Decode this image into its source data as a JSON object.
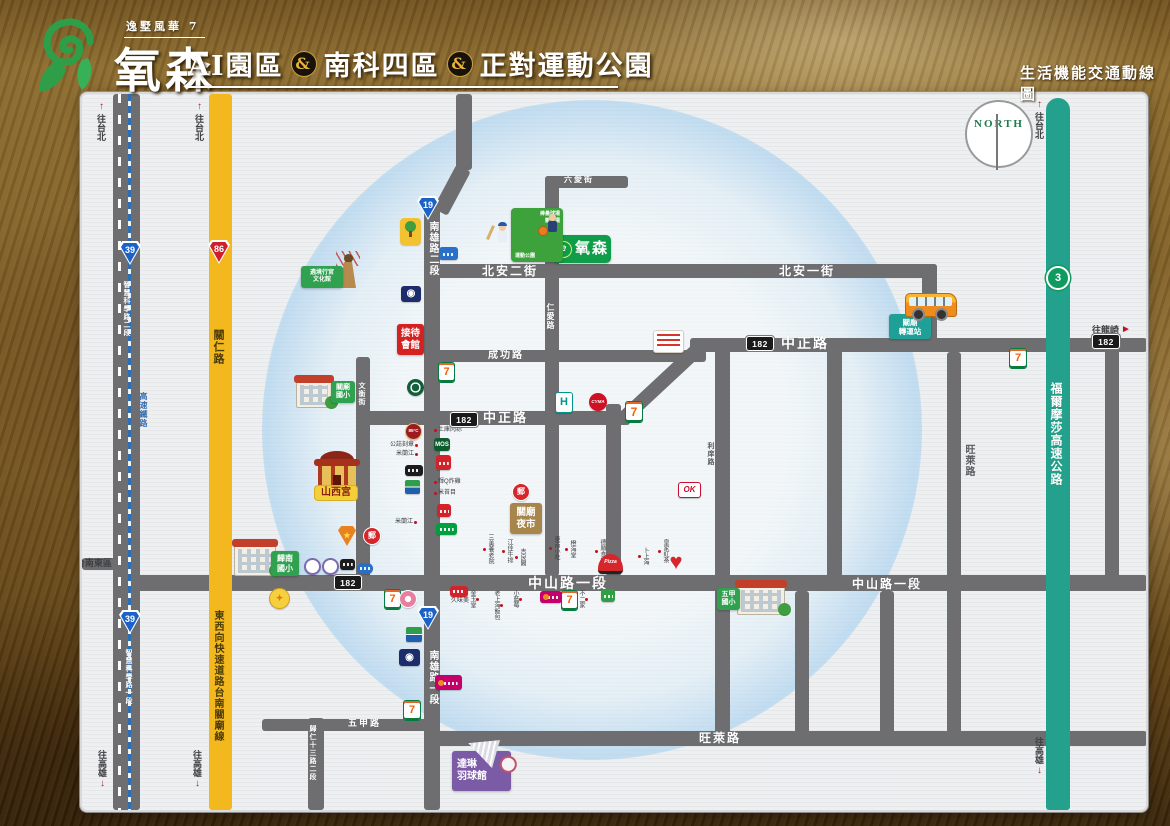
{
  "header": {
    "brand_top": "逸墅風華 7",
    "brand_name": "氧森",
    "title_segments": [
      "AI園區",
      "&",
      "南科四區",
      "&",
      "正對運動公園"
    ],
    "map_type": "生活機能交通動線圖"
  },
  "compass": {
    "label": "NORTH"
  },
  "site": {
    "logo_glyph": "e"
  },
  "roadLabels": [
    {
      "id": "beian-2nd-street",
      "text": "北安二街"
    },
    {
      "id": "beian-1st-street",
      "text": "北安一街"
    },
    {
      "id": "zhongzheng-road-north",
      "text": "中正路"
    },
    {
      "id": "zhongzheng-road-south",
      "text": "中正路"
    },
    {
      "id": "chenggong-road",
      "text": "成功路"
    },
    {
      "id": "zhongshan-road-sec1-west",
      "text": "中山路一段"
    },
    {
      "id": "zhongshan-road-sec1-east",
      "text": "中山路一段"
    },
    {
      "id": "wanglai-road-h",
      "text": "旺萊路"
    },
    {
      "id": "wanglai-road-v",
      "text": "旺萊路"
    },
    {
      "id": "wujia-road",
      "text": "五甲路"
    },
    {
      "id": "liuai-street",
      "text": "六愛街"
    },
    {
      "id": "renai-road",
      "text": "仁愛路"
    },
    {
      "id": "wenheng-street",
      "text": "文衡街"
    },
    {
      "id": "lixiang-road",
      "text": "利庠路"
    },
    {
      "id": "nanxiong-road-sec2",
      "text": "南雄路二段"
    },
    {
      "id": "nanxiong-road-sec1",
      "text": "南雄路一段"
    },
    {
      "id": "guiren-13th-road",
      "text": "歸仁十三路二段"
    },
    {
      "id": "guanren-road",
      "text": "關仁路"
    },
    {
      "id": "expressway-name",
      "text": "東西向快速道路台南關廟線"
    },
    {
      "id": "formosa-freeway",
      "text": "福爾摩莎高速公路"
    },
    {
      "id": "hsr-line",
      "text": "高速鐵路"
    },
    {
      "id": "smart-science-road-sec2",
      "text": "智慧科學路二段"
    },
    {
      "id": "smart-science-road-sec1",
      "text": "智慧科學路一段"
    }
  ],
  "dirLabels": [
    {
      "id": "to-taipei-1",
      "text": "往台北",
      "dir": "up"
    },
    {
      "id": "to-taipei-2",
      "text": "往台北",
      "dir": "up"
    },
    {
      "id": "to-taipei-3",
      "text": "往台北",
      "dir": "up"
    },
    {
      "id": "to-kaohsiung-1",
      "text": "往高雄",
      "dir": "down"
    },
    {
      "id": "to-kaohsiung-2",
      "text": "往高雄",
      "dir": "down"
    },
    {
      "id": "to-kaohsiung-3",
      "text": "往高雄",
      "dir": "down"
    },
    {
      "id": "to-tainan-east",
      "text": "往台南東區",
      "dir": "left"
    },
    {
      "id": "to-longqi",
      "text": "往龍崎",
      "dir": "right"
    }
  ],
  "shields": [
    {
      "id": "provincial-19-north",
      "number": "19"
    },
    {
      "id": "provincial-19-south",
      "number": "19"
    },
    {
      "id": "provincial-39-north",
      "number": "39"
    },
    {
      "id": "provincial-39-south",
      "number": "39"
    },
    {
      "id": "expressway-86",
      "number": "86"
    },
    {
      "id": "freeway-3",
      "number": "3"
    },
    {
      "id": "route-182-west",
      "number": "182"
    },
    {
      "id": "route-182-central",
      "number": "182"
    },
    {
      "id": "route-182-north",
      "number": "182"
    },
    {
      "id": "route-182-east",
      "number": "182"
    }
  ],
  "landmarks": [
    {
      "id": "site-sign",
      "lines": [
        "氧森"
      ]
    },
    {
      "id": "sports-park",
      "lines": [
        "棒壘球場",
        "籃球場",
        "運動公園"
      ]
    },
    {
      "id": "reception-hall",
      "lines": [
        "接待",
        "會館"
      ]
    },
    {
      "id": "shanxi-temple-label",
      "lines": [
        "山西宮"
      ]
    },
    {
      "id": "temple-culture-label",
      "lines": [
        "遶境行宮",
        "文化館"
      ]
    },
    {
      "id": "guanmiao-night-market",
      "lines": [
        "關廟",
        "夜市"
      ]
    },
    {
      "id": "dalin-badminton-hall",
      "lines": [
        "達琳",
        "羽球館"
      ]
    },
    {
      "id": "guanmiao-bus-station",
      "lines": [
        "關廟",
        "轉運站"
      ]
    },
    {
      "id": "guannan-elementary",
      "lines": [
        "歸南",
        "國小"
      ]
    },
    {
      "id": "guanmiao-elementary",
      "lines": [
        "關廟",
        "國小"
      ]
    },
    {
      "id": "wujia-elementary",
      "lines": [
        "五甲",
        "國小"
      ]
    }
  ],
  "microLabels": [
    {
      "id": "poi-tuku-rice-dumpling",
      "text": "土庫肉粽",
      "dot": "left"
    },
    {
      "id": "poi-seal-shop",
      "text": "公誌刻章",
      "dot": "right"
    },
    {
      "id": "poi-milanjiang-1",
      "text": "米蘭江",
      "dot": "right"
    },
    {
      "id": "poi-fried-chicken",
      "text": "輝Q炸雞",
      "dot": "left"
    },
    {
      "id": "poi-mitaimu",
      "text": "米苔目",
      "dot": "left"
    },
    {
      "id": "poi-milanjiang-2",
      "text": "米蘭江",
      "dot": "right"
    },
    {
      "id": "poi-sanmei-nursing",
      "text": "三美養老院",
      "dot": "bottom"
    },
    {
      "id": "poi-jiangjia-steak",
      "text": "江佳牛排",
      "dot": "bottom"
    },
    {
      "id": "poi-jiliang-ge",
      "text": "吉良閣",
      "dot": "bottom"
    },
    {
      "id": "poi-dongnan-snack",
      "text": "東南小吃",
      "dot": "bottom"
    },
    {
      "id": "poi-chenghai-tang",
      "text": "橙海堂",
      "dot": "bottom"
    },
    {
      "id": "poi-deshun-eatery",
      "text": "德順食堂",
      "dot": "bottom"
    },
    {
      "id": "poi-bu-shanghai",
      "text": "卜上海",
      "dot": "bottom"
    },
    {
      "id": "poi-royal-tea",
      "text": "皇家紅茶",
      "dot": "bottom"
    },
    {
      "id": "poi-jinyutang",
      "text": "金玉堂",
      "dot": "top"
    },
    {
      "id": "poi-fanbao",
      "text": "老上海飯包",
      "dot": "top"
    },
    {
      "id": "poi-blueberry",
      "text": "小藍莓",
      "dot": "top"
    },
    {
      "id": "poi-bujia",
      "text": "不二家",
      "dot": "top"
    },
    {
      "id": "poi-jiuweimei",
      "text": "久味美",
      "dot": "none"
    }
  ],
  "brandIcons": [
    {
      "id": "seven-eleven-1",
      "glyph": "7"
    },
    {
      "id": "seven-eleven-2",
      "glyph": "7"
    },
    {
      "id": "seven-eleven-3",
      "glyph": "7"
    },
    {
      "id": "seven-eleven-4",
      "glyph": "7"
    },
    {
      "id": "seven-eleven-5",
      "glyph": "7"
    },
    {
      "id": "seven-eleven-6",
      "glyph": "7"
    },
    {
      "id": "hi-life",
      "glyph": "H"
    },
    {
      "id": "cyma-mart",
      "glyph": "CYMA"
    },
    {
      "id": "ok-mart",
      "glyph": "OK"
    },
    {
      "id": "pizza-hut",
      "glyph": "Pizza"
    },
    {
      "id": "heart-clinic",
      "glyph": "♥"
    },
    {
      "id": "coffee-shop",
      "glyph": ""
    },
    {
      "id": "85c-cafe",
      "glyph": "85°C"
    },
    {
      "id": "mos-burger",
      "glyph": "MOS"
    },
    {
      "id": "variety-store",
      "glyph": ""
    },
    {
      "id": "black-sign",
      "glyph": ""
    },
    {
      "id": "bank-1",
      "glyph": ""
    },
    {
      "id": "bank-2",
      "glyph": ""
    },
    {
      "id": "post-office-1",
      "glyph": "郵"
    },
    {
      "id": "post-office-2",
      "glyph": "郵"
    },
    {
      "id": "farmers-association-1",
      "glyph": "◉"
    },
    {
      "id": "farmers-association-2",
      "glyph": "◉"
    },
    {
      "id": "police-badge",
      "glyph": "★"
    },
    {
      "id": "dark-plate-sign",
      "glyph": ""
    },
    {
      "id": "blue-oval-sign",
      "glyph": ""
    },
    {
      "id": "school-badge-1",
      "glyph": ""
    },
    {
      "id": "school-badge-2",
      "glyph": ""
    },
    {
      "id": "gold-emblem",
      "glyph": "✦"
    },
    {
      "id": "pink-circle-brand",
      "glyph": ""
    },
    {
      "id": "simple-mart",
      "glyph": ""
    },
    {
      "id": "poya-store",
      "glyph": ""
    },
    {
      "id": "hero-sign",
      "glyph": ""
    },
    {
      "id": "red-text-sign",
      "glyph": ""
    },
    {
      "id": "blue-sign",
      "glyph": ""
    },
    {
      "id": "family-mart",
      "glyph": ""
    },
    {
      "id": "red-store-2",
      "glyph": ""
    },
    {
      "id": "green-sign",
      "glyph": ""
    },
    {
      "id": "park",
      "glyph": ""
    }
  ]
}
